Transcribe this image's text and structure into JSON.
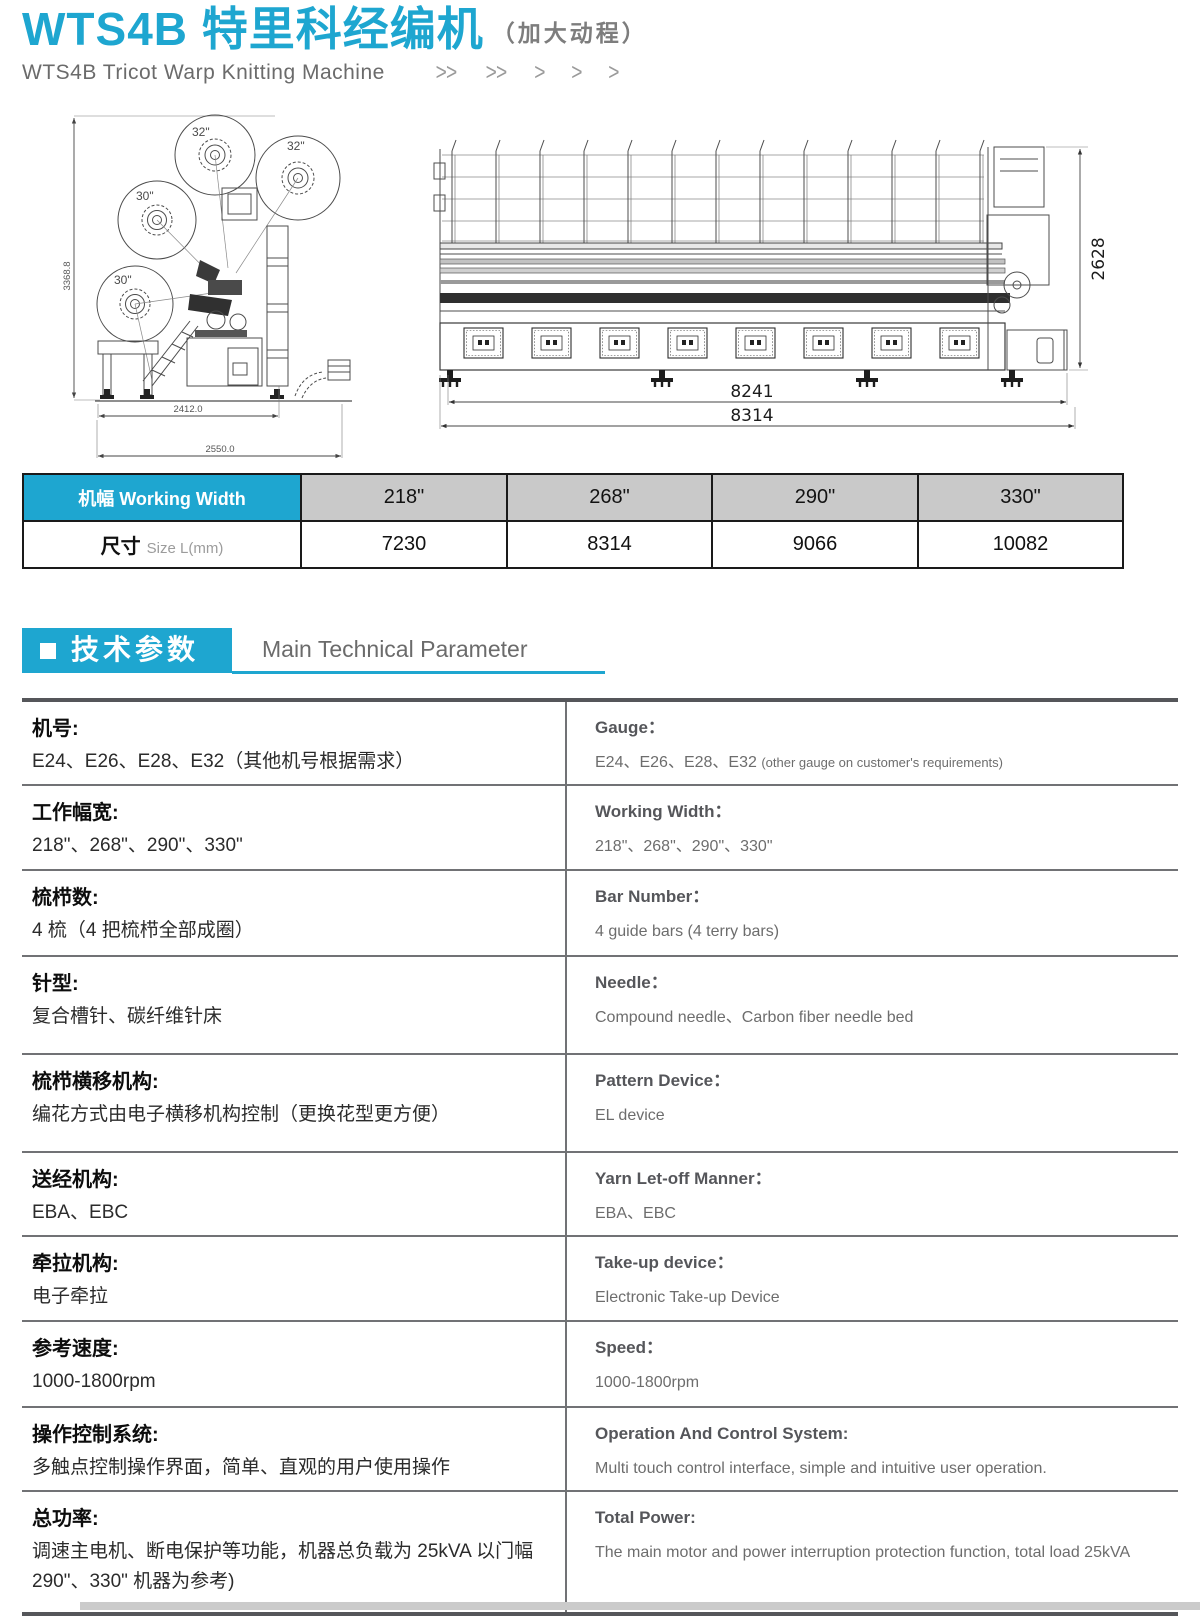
{
  "colors": {
    "accent": "#1ea6d0"
  },
  "header": {
    "title_zh": "WTS4B 特里科经编机",
    "title_suffix": "（加大动程）",
    "subtitle_en": "WTS4B Tricot Warp Knitting Machine",
    "chevrons": [
      ">>",
      ">>",
      ">",
      ">",
      ">"
    ]
  },
  "drawings": {
    "side_view": {
      "beam_labels": [
        "32\"",
        "32\"",
        "30\"",
        "30\""
      ],
      "dim_height": "3368.8",
      "dim_width_inner": "2412.0",
      "dim_width_outer": "2550.0"
    },
    "front_view": {
      "dim_height": "2628",
      "dim_width_inner": "8241",
      "dim_width_outer": "8314"
    }
  },
  "size_table": {
    "header_label": "机幅 Working Width",
    "row_label_zh": "尺寸",
    "row_label_en": "Size L(mm)",
    "columns": [
      "218\"",
      "268\"",
      "290\"",
      "330\""
    ],
    "values": [
      "7230",
      "8314",
      "9066",
      "10082"
    ]
  },
  "section": {
    "title_zh": "技术参数",
    "title_en": "Main Technical Parameter"
  },
  "specs": [
    {
      "zh_label": "机号:",
      "zh_value": "E24、E26、E28、E32（其他机号根据需求）",
      "en_label": "Gauge：",
      "en_value": "E24、E26、E28、E32",
      "en_note": "(other gauge on customer's requirements)"
    },
    {
      "zh_label": "工作幅宽:",
      "zh_value": "218\"、268\"、290\"、330\"",
      "en_label": "Working Width：",
      "en_value": "218\"、268\"、290\"、330\"",
      "en_note": ""
    },
    {
      "zh_label": "梳栉数:",
      "zh_value": "4 梳（4 把梳栉全部成圈）",
      "en_label": "Bar Number：",
      "en_value": "4 guide bars (4 terry bars)",
      "en_note": ""
    },
    {
      "zh_label": "针型:",
      "zh_value": "复合槽针、碳纤维针床",
      "en_label": "Needle：",
      "en_value": "Compound needle、Carbon fiber needle bed",
      "en_note": ""
    },
    {
      "zh_label": "梳栉横移机构:",
      "zh_value": "编花方式由电子横移机构控制（更换花型更方便）",
      "en_label": "Pattern Device：",
      "en_value": "EL device",
      "en_note": ""
    },
    {
      "zh_label": "送经机构:",
      "zh_value": "EBA、EBC",
      "en_label": "Yarn Let-off Manner：",
      "en_value": "EBA、EBC",
      "en_note": ""
    },
    {
      "zh_label": "牵拉机构:",
      "zh_value": "电子牵拉",
      "en_label": "Take-up device：",
      "en_value": "Electronic Take-up Device",
      "en_note": ""
    },
    {
      "zh_label": "参考速度:",
      "zh_value": "1000-1800rpm",
      "en_label": "Speed：",
      "en_value": "1000-1800rpm",
      "en_note": ""
    },
    {
      "zh_label": "操作控制系统:",
      "zh_value": "多触点控制操作界面，简单、直观的用户使用操作",
      "en_label": "Operation And Control System:",
      "en_value": "Multi touch control interface, simple and intuitive user operation.",
      "en_note": ""
    },
    {
      "zh_label": "总功率:",
      "zh_value": "调速主电机、断电保护等功能，机器总负载为 25kVA 以门幅 290\"、330\" 机器为参考)",
      "en_label": "Total Power:",
      "en_value": "The main motor and power interruption protection function,  total load 25kVA",
      "en_note": ""
    }
  ]
}
